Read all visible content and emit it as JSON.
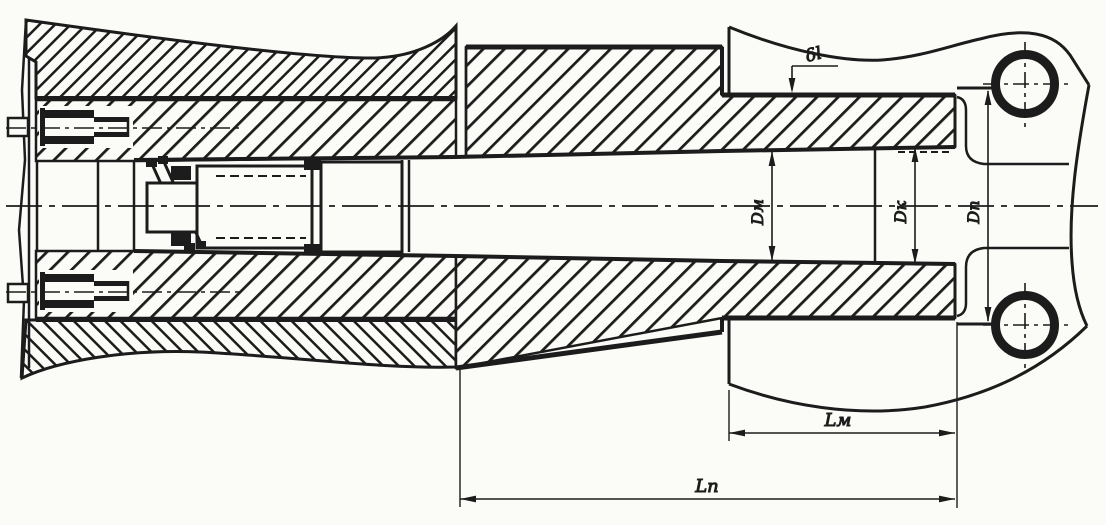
{
  "labels": {
    "delta_l": "δl",
    "d_m": "Dм",
    "d_k": "Dк",
    "d_p": "Dп",
    "l_m": "Lм",
    "l_p": "Lп"
  },
  "colors": {
    "ink": "#1c1c1c",
    "paper": "#fbfbf8"
  }
}
